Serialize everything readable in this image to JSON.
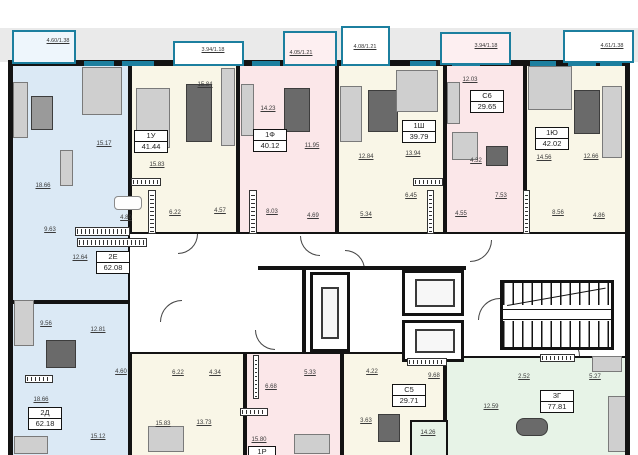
{
  "colors": {
    "wall": "#131313",
    "window_teal": "#1c7f9f",
    "apartment_blue": "#dbe9f5",
    "apartment_cream": "#f9f6e7",
    "apartment_pink": "#fbe7e9",
    "apartment_green": "#e7f3e7",
    "exterior_gray": "#eaeaea"
  },
  "balconies": {
    "b1": "4.60/1.38",
    "b2": "3.94/1.18",
    "b3": "4.05/1.21",
    "b4": "4.08/1.21",
    "b5": "3.94/1.18",
    "b6": "4.61/1.38"
  },
  "apartments": {
    "e2": {
      "type": "2Е",
      "area": "62.08",
      "rooms": {
        "living": "18.66",
        "bedroom": "15.17",
        "hall": "9.63",
        "kitchen": "12.64",
        "bath": "4.80"
      }
    },
    "u1": {
      "type": "1У",
      "area": "41.44",
      "rooms": {
        "kitchen_living": "15.84",
        "bedroom": "15.83",
        "hall": "6.22",
        "bath": "4.57"
      }
    },
    "f1": {
      "type": "1Ф",
      "area": "40.12",
      "rooms": {
        "bedroom": "14.23",
        "kitchen_living": "11.95",
        "hall": "8.03",
        "bath": "4.69"
      }
    },
    "sh1": {
      "type": "1Ш",
      "area": "39.79",
      "rooms": {
        "kitchen_living": "12.84",
        "bedroom": "13.94",
        "hall": "6.45",
        "bath": "5.34"
      }
    },
    "s6": {
      "type": "С6",
      "area": "29.65",
      "rooms": {
        "living": "12.03",
        "kitchen": "4.32",
        "bath": "4.55",
        "hall": "7.53"
      }
    },
    "yu1": {
      "type": "1Ю",
      "area": "42.02",
      "rooms": {
        "bedroom": "14.56",
        "kitchen_living": "12.66",
        "hall": "8.56",
        "bath": "4.86"
      }
    },
    "d2": {
      "type": "2Д",
      "area": "62.18",
      "rooms": {
        "hall": "9.56",
        "living": "12.81",
        "bath": "4.60",
        "bedroom": "18.66",
        "room2": "15.12"
      }
    },
    "bm": {
      "rooms": {
        "hall": "6.22",
        "bath": "4.34",
        "room1": "15.83",
        "room2": "13.73"
      }
    },
    "p1": {
      "type": "1Р",
      "rooms": {
        "hall": "6.68",
        "bath": "5.33",
        "room": "15.80"
      }
    },
    "s5": {
      "type": "С5",
      "area": "29.71",
      "rooms": {
        "wc": "4.22",
        "shower": "3.63",
        "hall": "9.68"
      }
    },
    "g3": {
      "type": "3Г",
      "area": "77.81",
      "rooms": {
        "wc": "2.52",
        "bath": "5.27",
        "hall": "12.59",
        "room": "14.26"
      }
    }
  }
}
